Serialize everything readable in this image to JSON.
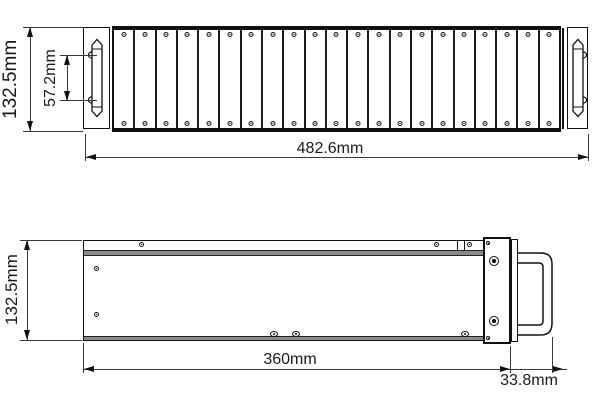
{
  "drawing": {
    "front_view": {
      "name": "front view",
      "slat_count": 21,
      "dim_height": "132.5mm",
      "dim_handle_span": "57.2mm",
      "dim_width": "482.6mm"
    },
    "side_view": {
      "name": "side view",
      "dim_height": "132.5mm",
      "dim_length": "360mm",
      "dim_handle_depth": "33.8mm"
    },
    "colors": {
      "line": "#1a1a1a",
      "seam_gray": "#8a8a8a",
      "background": "#ffffff"
    }
  }
}
